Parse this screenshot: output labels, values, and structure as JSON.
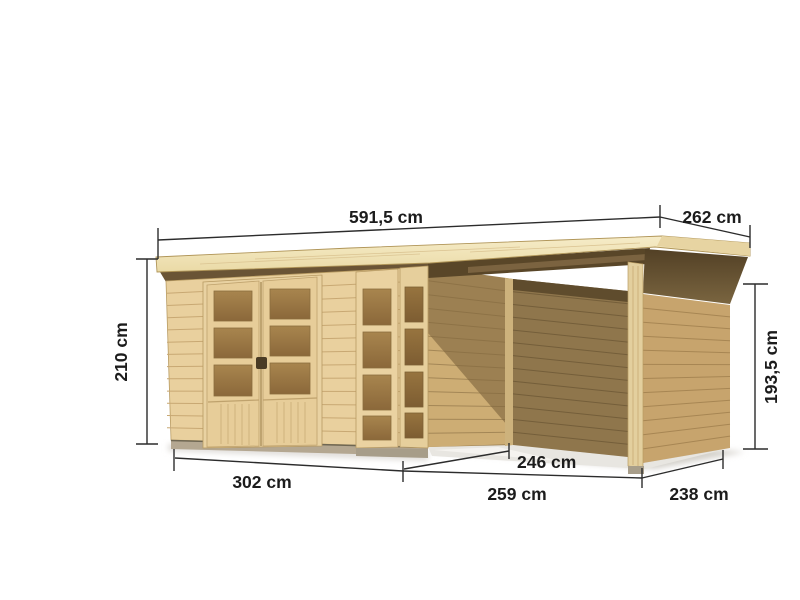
{
  "scene": {
    "description": "wooden flat-roof garden shed with glazed double door, corner window element and attached open side canopy, shown with dimension lines",
    "background": "#ffffff"
  },
  "dimensions": [
    {
      "id": "roof-width",
      "label": "591,5 cm"
    },
    {
      "id": "roof-depth",
      "label": "262 cm"
    },
    {
      "id": "height-left",
      "label": "210 cm"
    },
    {
      "id": "wall-height-right",
      "label": "193,5 cm"
    },
    {
      "id": "house-front-width",
      "label": "302 cm"
    },
    {
      "id": "canopy-inner-depth",
      "label": "246 cm"
    },
    {
      "id": "canopy-front-width",
      "label": "259 cm"
    },
    {
      "id": "side-depth-right",
      "label": "238 cm"
    }
  ],
  "colors": {
    "dimension_line": "#2c2c2c",
    "dimension_text": "#1c1c1c",
    "roof_top": "#f5e9c2",
    "roof_edge": "#eddcac",
    "wall_light": "#e9d09e",
    "plank_line": "#c8a873",
    "door_frame": "#e9d2a2",
    "window_pane": "#9a7845",
    "shadow_wall": "#9c8052",
    "back_wall": "#8f764c",
    "side_wall_right": "#c7a46d",
    "soffit_dark": "#5c4a2c",
    "foundation": "#b4a791",
    "ground_shadow": "#d8d5cf"
  }
}
